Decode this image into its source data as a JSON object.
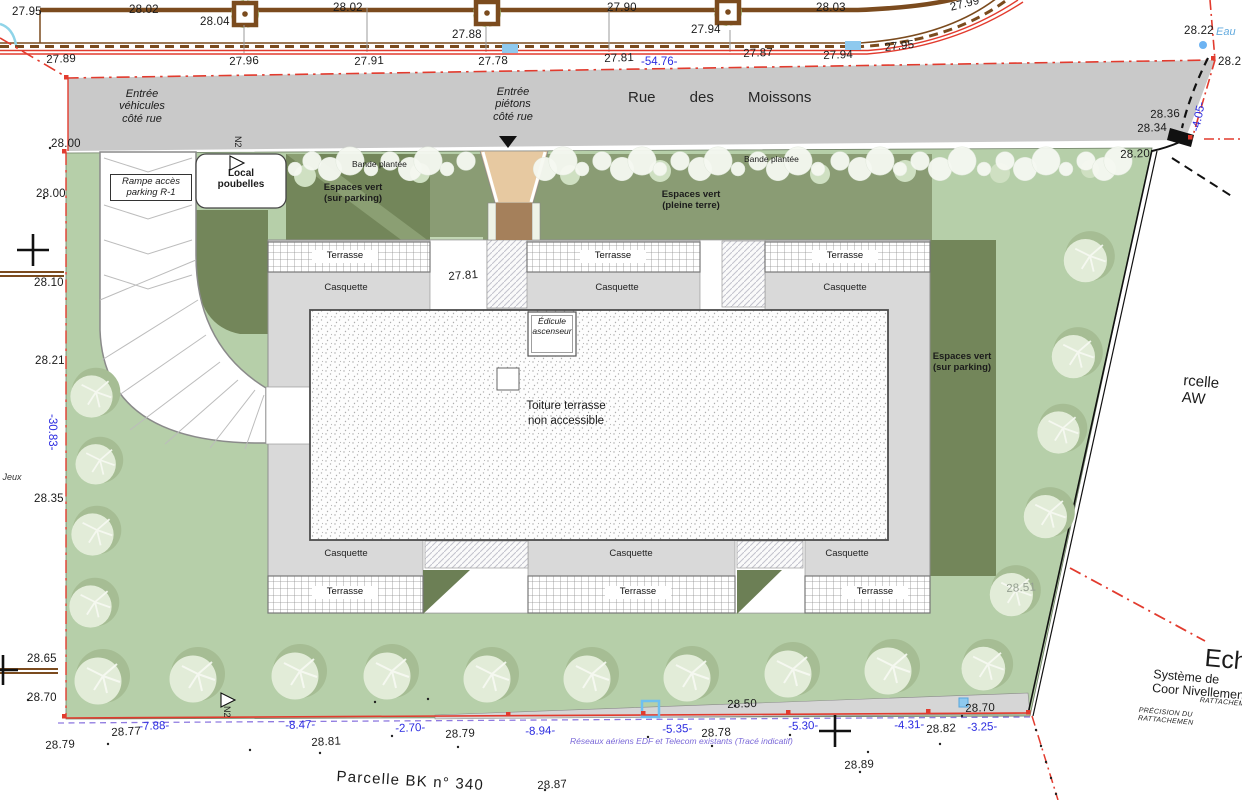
{
  "street": {
    "name": "Rue des Moissons"
  },
  "areas": {
    "entree_vehicules": "Entrée\nvéhicules\ncôté rue",
    "entree_pietons": "Entrée\npiétons\ncôté rue",
    "rampe": "Rampe accès\nparking R-1",
    "local_poubelles": "Local\npoubelles",
    "espaces_vert_parking_left": "Espaces vert\n(sur parking)",
    "espaces_vert_pleine_terre": "Espaces vert\n(pleine terre)",
    "espaces_vert_parking_right": "Espaces vert\n(sur parking)",
    "bande_plantee_left": "Bande plantée",
    "bande_plantee_right": "Bande plantée"
  },
  "building": {
    "toiture": "Toiture terrasse\nnon accessible",
    "edicule": "Édicule\nascenseur",
    "terrasse_labels": [
      {
        "t": "Terrasse",
        "x": 312,
        "y": 250
      },
      {
        "t": "Terrasse",
        "x": 580,
        "y": 250
      },
      {
        "t": "Terrasse",
        "x": 812,
        "y": 250
      },
      {
        "t": "Terrasse",
        "x": 312,
        "y": 586
      },
      {
        "t": "Terrasse",
        "x": 605,
        "y": 586
      },
      {
        "t": "Terrasse",
        "x": 842,
        "y": 586
      }
    ],
    "casquette_labels": [
      {
        "t": "Casquette",
        "x": 316,
        "y": 283
      },
      {
        "t": "Casquette",
        "x": 587,
        "y": 283
      },
      {
        "t": "Casquette",
        "x": 815,
        "y": 283
      },
      {
        "t": "Casquette",
        "x": 316,
        "y": 549
      },
      {
        "t": "Casquette",
        "x": 601,
        "y": 549
      },
      {
        "t": "Casquette",
        "x": 817,
        "y": 549
      }
    ]
  },
  "survey": {
    "elev_black": [
      {
        "t": "27.95",
        "x": 12,
        "y": 6
      },
      {
        "t": "28.02",
        "x": 129,
        "y": 4
      },
      {
        "t": "28.04",
        "x": 200,
        "y": 16
      },
      {
        "t": "28.02",
        "x": 333,
        "y": 2
      },
      {
        "t": "27.88",
        "x": 452,
        "y": 29
      },
      {
        "t": "27.90",
        "x": 607,
        "y": 2
      },
      {
        "t": "27.94",
        "x": 691,
        "y": 24
      },
      {
        "t": "28.03",
        "x": 816,
        "y": 2
      },
      {
        "t": "27.99",
        "x": 949,
        "y": 2,
        "r": -14
      },
      {
        "t": "27.89",
        "x": 46,
        "y": 54,
        "r": -2
      },
      {
        "t": "27.96",
        "x": 229,
        "y": 56,
        "r": -2
      },
      {
        "t": "27.91",
        "x": 354,
        "y": 56,
        "r": -2
      },
      {
        "t": "27.78",
        "x": 478,
        "y": 56,
        "r": -2
      },
      {
        "t": "27.81",
        "x": 604,
        "y": 53,
        "r": -2
      },
      {
        "t": "27.87",
        "x": 743,
        "y": 48,
        "r": -2
      },
      {
        "t": "27.94",
        "x": 823,
        "y": 50,
        "r": -2
      },
      {
        "t": "27.95",
        "x": 884,
        "y": 42,
        "r": -6
      },
      {
        "t": "28.22",
        "x": 1184,
        "y": 25
      },
      {
        "t": "28.2",
        "x": 1218,
        "y": 56
      },
      {
        "t": "28.36",
        "x": 1150,
        "y": 109,
        "r": -2
      },
      {
        "t": "28.34",
        "x": 1137,
        "y": 123,
        "r": -2
      },
      {
        "t": "28.20",
        "x": 1120,
        "y": 149,
        "r": -2
      },
      {
        "t": "28.00",
        "x": 51,
        "y": 138
      },
      {
        "t": "28.00",
        "x": 36,
        "y": 188
      },
      {
        "t": "28.10",
        "x": 34,
        "y": 277
      },
      {
        "t": "28.21",
        "x": 35,
        "y": 355
      },
      {
        "t": "28.35",
        "x": 34,
        "y": 493
      },
      {
        "t": "28.65",
        "x": 27,
        "y": 653
      },
      {
        "t": "28.70",
        "x": 27,
        "y": 692
      },
      {
        "t": "28.79",
        "x": 45,
        "y": 740,
        "r": -3
      },
      {
        "t": "28.77",
        "x": 111,
        "y": 727,
        "r": -3
      },
      {
        "t": "28.81",
        "x": 311,
        "y": 737,
        "r": -3
      },
      {
        "t": "28.79",
        "x": 445,
        "y": 729,
        "r": -3
      },
      {
        "t": "28.78",
        "x": 701,
        "y": 728,
        "r": -3
      },
      {
        "t": "28.50",
        "x": 727,
        "y": 699,
        "r": -2
      },
      {
        "t": "28.82",
        "x": 926,
        "y": 724,
        "r": -3
      },
      {
        "t": "28.70",
        "x": 965,
        "y": 703,
        "r": -2
      },
      {
        "t": "28.89",
        "x": 844,
        "y": 760,
        "r": -3
      },
      {
        "t": "28.87",
        "x": 537,
        "y": 780,
        "r": -3
      },
      {
        "t": "27.81",
        "x": 448,
        "y": 271,
        "r": -4
      },
      {
        "t": "28.51",
        "x": 1006,
        "y": 583,
        "r": -3,
        "c": "#96a092"
      }
    ],
    "dim_blue": [
      {
        "t": "-54.76-",
        "x": 641,
        "y": 56
      },
      {
        "t": "-4.05-",
        "x": 1190,
        "y": 130,
        "r": -78
      },
      {
        "t": "-30.83-",
        "x": 58,
        "y": 414,
        "r": 90
      },
      {
        "t": "-7.88-",
        "x": 139,
        "y": 721,
        "r": -2
      },
      {
        "t": "-8.47-",
        "x": 285,
        "y": 720,
        "r": -2
      },
      {
        "t": "-2.70-",
        "x": 395,
        "y": 723,
        "r": -2
      },
      {
        "t": "-8.94-",
        "x": 525,
        "y": 726,
        "r": -2
      },
      {
        "t": "-5.35-",
        "x": 662,
        "y": 724,
        "r": -2
      },
      {
        "t": "-5.30-",
        "x": 788,
        "y": 721,
        "r": -2
      },
      {
        "t": "-4.31-",
        "x": 894,
        "y": 720,
        "r": -2
      },
      {
        "t": "-3.25-",
        "x": 967,
        "y": 722,
        "r": -2
      }
    ]
  },
  "annotations": {
    "parcelle_bk": "Parcelle BK n° 340",
    "parcelle_aw": "rcelle AW",
    "jeux": "e Jeux",
    "reseaux": "Réseaux aériens EDF et Telecom existants (Tracé indicatif)",
    "eau": "Eau",
    "n2": "N2",
    "echelle": "Ech",
    "systeme": "Système de Coor",
    "nivellement": "Nivellemen",
    "rattachement": "RATTACHEMEN",
    "precision": "PRÉCISION DU RATTACHEMEN"
  },
  "colors": {
    "lawn": "#b6cfa9",
    "deck_green": "#8a9c74",
    "dark_green": "#73865a",
    "street_gray": "#c9c9c9",
    "building_gray": "#d9d9d9",
    "boundary_red": "#e23b2e",
    "dim_blue": "#2b2be0",
    "utility_purple": "#8f7ae0",
    "fence_brown": "#7b4b1e",
    "walkway_tan": "#e7c9a1",
    "water_blue": "#8ec9ee"
  }
}
